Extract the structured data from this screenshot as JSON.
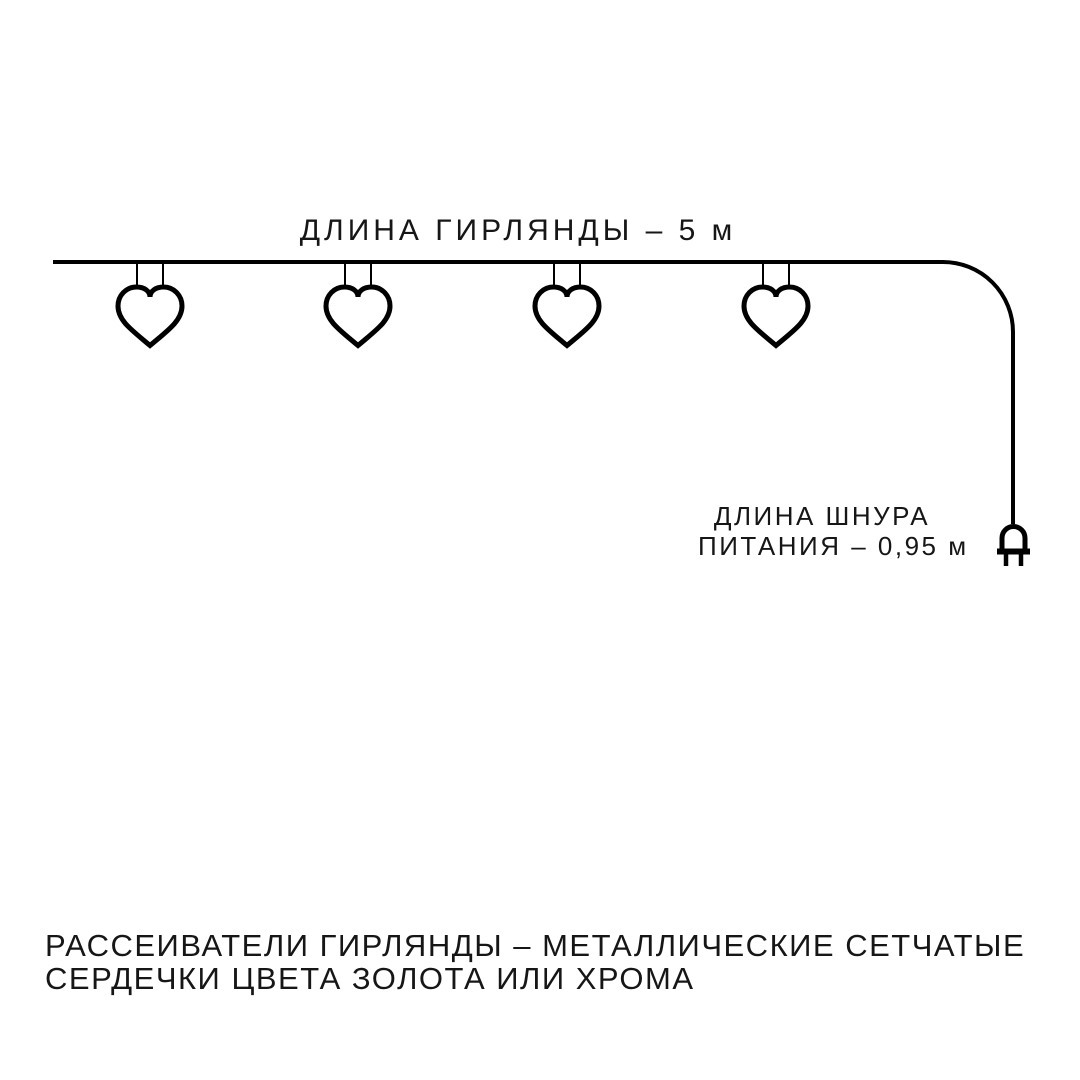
{
  "page": {
    "background_color": "#ffffff",
    "line_color": "#000000",
    "text_color": "#161616"
  },
  "diagram": {
    "garland_length_label": "ДЛИНА ГИРЛЯНДЫ – 5 м",
    "garland_length_value": "5 м",
    "cord_label_line1": "ДЛИНА ШНУРА",
    "cord_label_line2": "ПИТАНИЯ – 0,95 м",
    "cord_length_value": "0,95 м",
    "hearts_count": 4,
    "heart_icon": "heart-outline",
    "plug_icon": "power-plug"
  },
  "footer": {
    "line1": "РАССЕИВАТЕЛИ ГИРЛЯНДЫ – МЕТАЛЛИЧЕСКИЕ СЕТЧАТЫЕ",
    "line2": "СЕРДЕЧКИ ЦВЕТА ЗОЛОТА ИЛИ ХРОМА"
  }
}
